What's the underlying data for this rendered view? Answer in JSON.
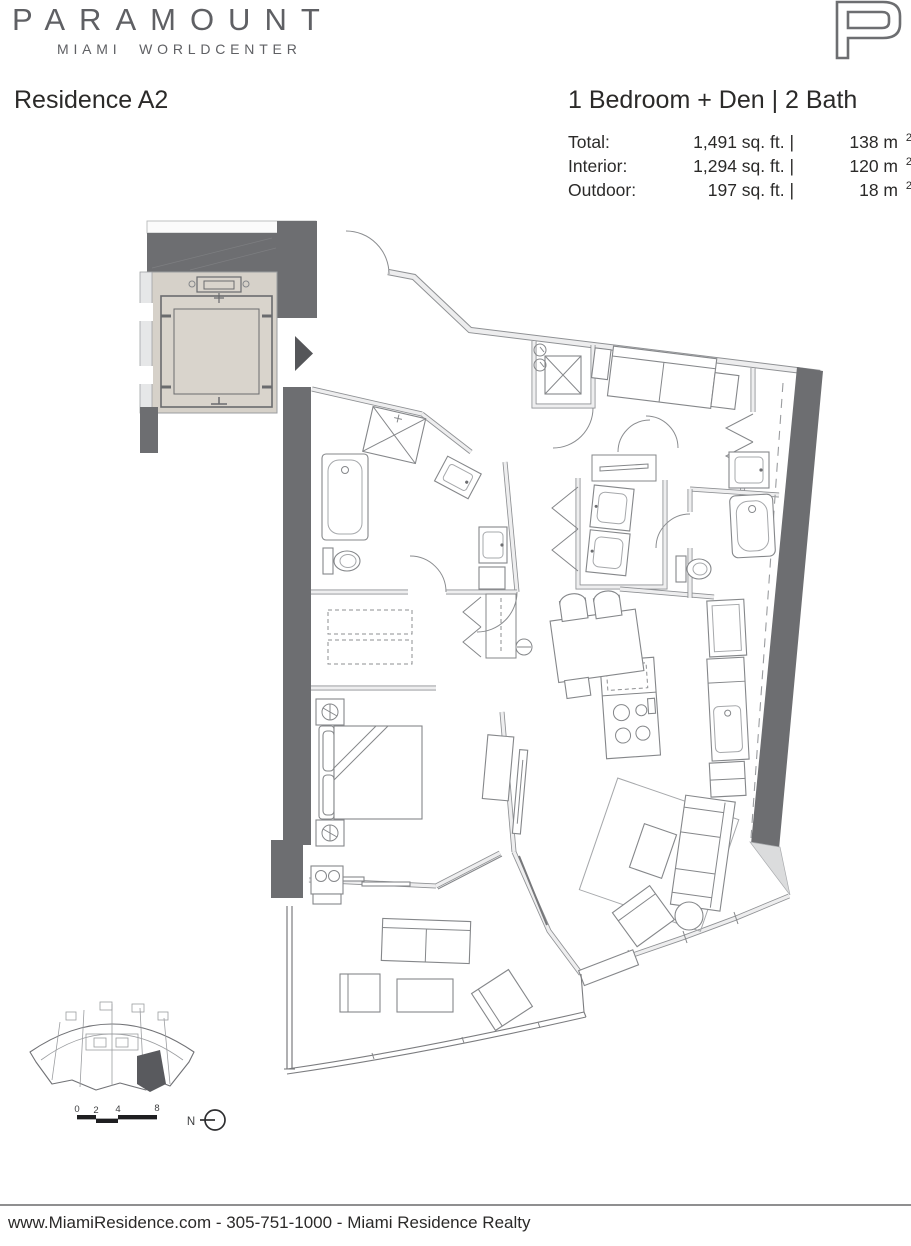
{
  "brand": {
    "wordmark": "PARAMOUNT",
    "tagline": "MIAMI WORLDCENTER",
    "logo_letter": "P"
  },
  "header": {
    "residence_name": "Residence A2",
    "configuration": "1 Bedroom + Den | 2 Bath",
    "areas": [
      {
        "label": "Total:",
        "imperial": "1,491 sq. ft. |",
        "metric": "138 m",
        "metric_sup": "2"
      },
      {
        "label": "Interior:",
        "imperial": "1,294 sq. ft. |",
        "metric": "120 m",
        "metric_sup": "2"
      },
      {
        "label": "Outdoor:",
        "imperial": "197 sq. ft. |",
        "metric": "18 m",
        "metric_sup": "2"
      }
    ]
  },
  "keyplan": {
    "scale_ticks": [
      "0",
      "2",
      "4",
      "8"
    ],
    "north_label": "N"
  },
  "footer": {
    "text": "www.MiamiResidence.com  -  305-751-1000  -  Miami Residence Realty"
  },
  "colors": {
    "wall_dark": "#6d6e71",
    "wall_light": "#ededee",
    "elevator_fill": "#d6d1c9",
    "line_gray": "#85878a",
    "text": "#231f20",
    "brand_gray": "#5f6064"
  }
}
